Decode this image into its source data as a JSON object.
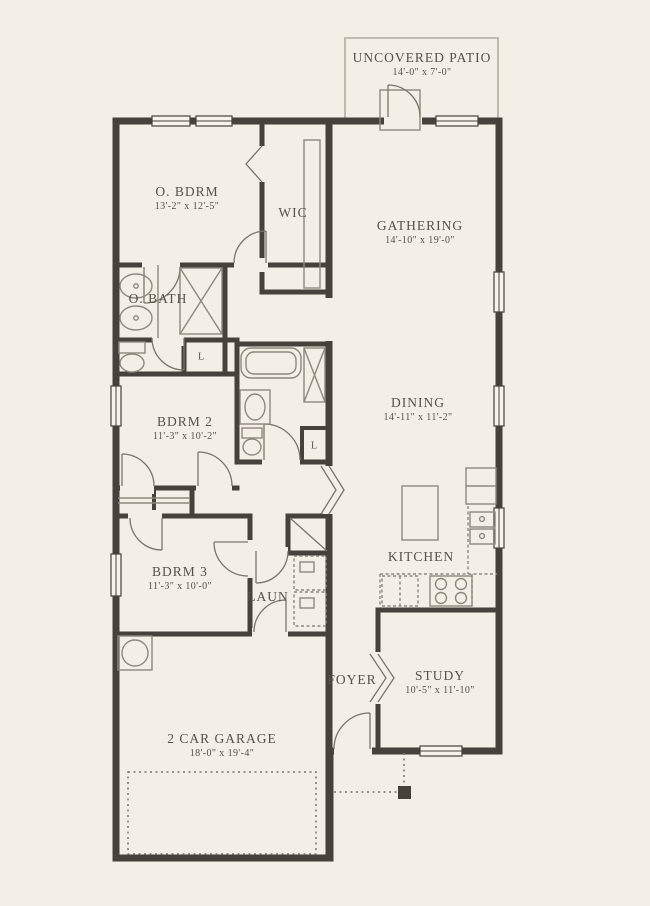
{
  "plan": {
    "colors": {
      "background": "#f3efe6",
      "wall": "#46413a",
      "fixture_line": "#8e887c",
      "text": "#575148"
    },
    "rooms": {
      "patio": {
        "name": "UNCOVERED PATIO",
        "dims": "14'-0\" x 7'-0\""
      },
      "o_bdrm": {
        "name": "O. BDRM",
        "dims": "13'-2\" x 12'-5\""
      },
      "wic": {
        "name": "WIC",
        "dims": ""
      },
      "gathering": {
        "name": "GATHERING",
        "dims": "14'-10\" x 19'-0\""
      },
      "o_bath": {
        "name": "O. BATH",
        "dims": ""
      },
      "dining": {
        "name": "DINING",
        "dims": "14'-11\" x 11'-2\""
      },
      "bdrm2": {
        "name": "BDRM 2",
        "dims": "11'-3\" x 10'-2\""
      },
      "bdrm3": {
        "name": "BDRM 3",
        "dims": "11'-3\" x 10'-0\""
      },
      "laun": {
        "name": "LAUN",
        "dims": ""
      },
      "kitchen": {
        "name": "KITCHEN",
        "dims": ""
      },
      "foyer": {
        "name": "FOYER",
        "dims": ""
      },
      "study": {
        "name": "STUDY",
        "dims": "10'-5\" x 11'-10\""
      },
      "garage": {
        "name": "2 CAR GARAGE",
        "dims": "18'-0\" x 19'-4\""
      }
    },
    "closets": {
      "linen_a": "L",
      "linen_b": "L"
    }
  }
}
